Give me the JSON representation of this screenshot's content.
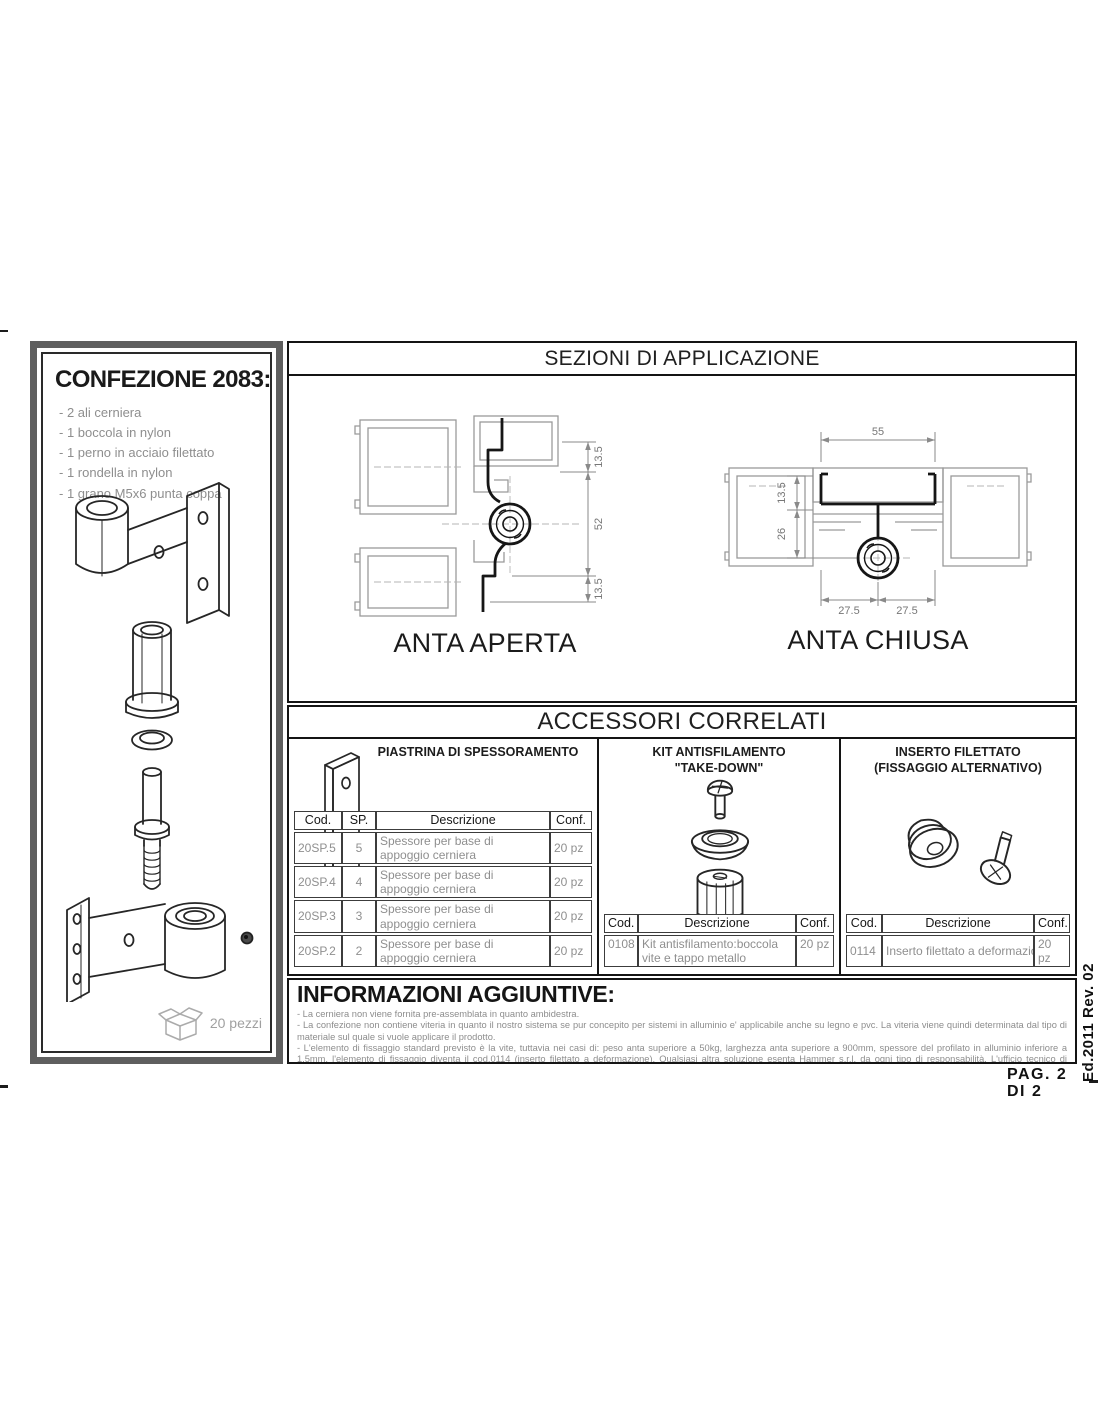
{
  "page": {
    "pag_label": "PAG. 2 DI 2",
    "edition_label": "Ed.2011 Rev. 02"
  },
  "confezione": {
    "title": "CONFEZIONE 2083:",
    "items": [
      "- 2 ali cerniera",
      "- 1 boccola in nylon",
      "- 1 perno in acciaio filettato",
      "- 1 rondella in nylon",
      "- 1 grano M5x6 punta coppa"
    ],
    "pieces_label": "20 pezzi"
  },
  "sezioni": {
    "title": "SEZIONI DI APPLICAZIONE",
    "anta_aperta": {
      "label": "ANTA APERTA",
      "dim_top": "13.5",
      "dim_mid": "52",
      "dim_bottom": "13.5"
    },
    "anta_chiusa": {
      "label": "ANTA CHIUSA",
      "dim_width": "55",
      "dim_upper": "13.5",
      "dim_lower": "26",
      "dim_left": "27.5",
      "dim_right": "27.5"
    }
  },
  "accessori": {
    "title": "ACCESSORI CORRELATI",
    "piastrina": {
      "title": "PIASTRINA DI SPESSORAMENTO",
      "headers": [
        "Cod.",
        "SP.",
        "Descrizione",
        "Conf."
      ],
      "rows": [
        [
          "20SP.5",
          "5",
          "Spessore per base di appoggio cerniera",
          "20 pz"
        ],
        [
          "20SP.4",
          "4",
          "Spessore per base di appoggio cerniera",
          "20 pz"
        ],
        [
          "20SP.3",
          "3",
          "Spessore per base di appoggio cerniera",
          "20 pz"
        ],
        [
          "20SP.2",
          "2",
          "Spessore per base di appoggio cerniera",
          "20 pz"
        ]
      ]
    },
    "kit": {
      "title_line1": "KIT ANTISFILAMENTO",
      "title_line2": "\"TAKE-DOWN\"",
      "headers": [
        "Cod.",
        "Descrizione",
        "Conf."
      ],
      "rows": [
        [
          "0108",
          "Kit antisfilamento:boccola vite e tappo metallo",
          "20 pz"
        ]
      ]
    },
    "inserto": {
      "title_line1": "INSERTO FILETTATO",
      "title_line2": "(FISSAGGIO ALTERNATIVO)",
      "headers": [
        "Cod.",
        "Descrizione",
        "Conf."
      ],
      "rows": [
        [
          "0114",
          "Inserto filettato a deformazione + vite",
          "20 pz"
        ]
      ]
    }
  },
  "informazioni": {
    "title": "INFORMAZIONI AGGIUNTIVE:",
    "bullets": [
      "- La cerniera non viene fornita pre-assemblata in quanto ambidestra.",
      "- La confezione non contiene viteria in quanto il nostro sistema se pur concepito per sistemi in alluminio e' applicabile anche su legno e pvc. La viteria viene quindi determinata dal tipo di materiale sul quale si vuole applicare il prodotto.",
      "- L'elemento di fissaggio standard previsto è la vite, tuttavia nei casi di: peso anta superiore a 50kg, larghezza anta superiore a 900mm, spessore del profilato in alluminio inferiore a 1,5mm, l'elemento di fissaggio diventa il cod.0114 (inserto filettato a deformazione). Qualsiasi altra soluzione esenta Hammer s.r.l. da ogni tipo di responsabilità. L'ufficio tecnico di Hammer s.r.l. è comunque a disposizione per valutare soluzioni di fissaggio alternative."
    ]
  }
}
